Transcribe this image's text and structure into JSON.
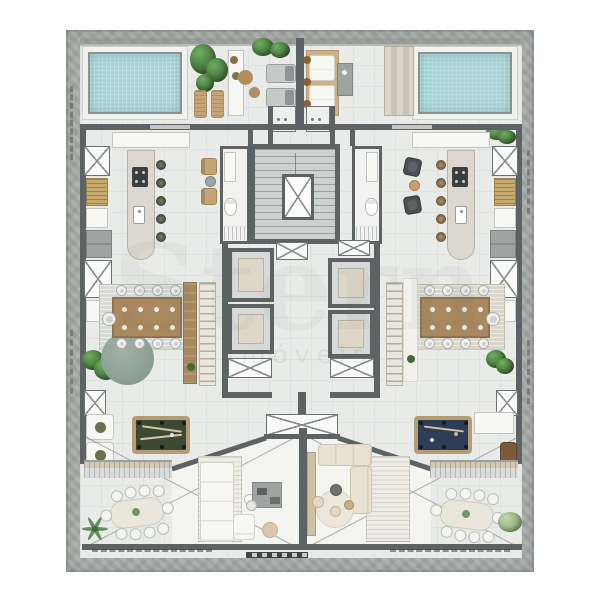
{
  "app": {
    "type": "architectural floor plan",
    "view": "top-down furnished render",
    "canvas": "600x600"
  },
  "watermark": {
    "large_text": "Stern",
    "small_text": "imóveis"
  },
  "colors": {
    "concrete": "#a8ada9",
    "concrete_dark": "#8f9490",
    "floor": "#e9ebe9",
    "tile_line": "#dfe2e0",
    "wall": "#5d6364",
    "pool_water": "#a3d5d7",
    "pool_rim": "#8a9092",
    "deck": "#f2f1ec",
    "white_furn": "#f7f7f4",
    "gray_furn": "#9fa3a2",
    "wood_tan": "#c3a577",
    "wood_slat": "#c6a96f",
    "dining_wood": "#a8895f",
    "dining_wood_dark": "#8f7350",
    "rug_round": "#8ea095",
    "shaft_beige": "#ded7c7",
    "felt_green": "#3c4a34",
    "felt_blue": "#2e3d56",
    "frame_wood": "#b59c74",
    "plant_light": "#6fae5f",
    "plant_mid": "#49793f",
    "plant_dark": "#2f5a2c",
    "beige_sofa": "#e9e2d2",
    "tan_pouf": "#d9c6ab"
  },
  "plan": {
    "layout": "two mirrored units around a central stair and elevator core",
    "core": {
      "features": [
        "staircase",
        "central elevator",
        "4 elevator shafts",
        "ventilation shafts (x-marked)",
        "left bathroom with toilet and shower",
        "right bathroom with toilet and shower",
        "entry grill counters (2)"
      ]
    },
    "shared_roof_terrace": {
      "items": [
        "lounge chairs (2)",
        "white sun loungers (2) with brown pillows",
        "tan sun loungers (2)",
        "ottomans (2)",
        "planters",
        "concrete side table",
        "stepped deck",
        "tall potted tree"
      ]
    },
    "unit_left": {
      "pool_terrace": [
        "swimming pool",
        "pool deck",
        "pool shelf",
        "sun loungers"
      ],
      "kitchen": [
        "island with cooktop and sink",
        "bar stools (5, olive)",
        "tan chairs (2) with round side table",
        "wall cabinets",
        "wood-slat cabinet",
        "appliance stack"
      ],
      "dining": [
        "wood dining table (9 seats)",
        "striped gray rug",
        "round green rug",
        "wood slat divider",
        "ladder shelf",
        "floor plants"
      ],
      "games_lounge": [
        "billiards table (green felt)",
        "white armchairs (2)"
      ],
      "living": [
        "white sectional sofa",
        "striped rug",
        "gray desk with chair",
        "tan ottoman",
        "coffee table"
      ],
      "terrace": [
        "outdoor oval dining table (10 seats)",
        "palm plant",
        "pergola band"
      ]
    },
    "unit_right": {
      "pool_terrace": [
        "swimming pool",
        "pool deck",
        "stepped platforms",
        "planter"
      ],
      "kitchen": [
        "island with cooktop and sink",
        "bar stools (5, brown)",
        "dark lounge chairs (2) with side table",
        "wall cabinets",
        "wood-slat cabinet",
        "appliance stack"
      ],
      "dining": [
        "wood dining table (9 seats)",
        "beige rug",
        "white sideboard with plant",
        "ladder shelf"
      ],
      "games_lounge": [
        "billiards table (blue felt)",
        "white bench",
        "leather armchair"
      ],
      "living": [
        "beige sectional sofa",
        "striped rug",
        "round beige rug",
        "poufs (2)",
        "dark side table",
        "tan door panel"
      ],
      "terrace": [
        "outdoor oval dining table (10 seats)",
        "soft green plant",
        "pergola band"
      ]
    },
    "annotations": [
      "ventilation shafts marked with X",
      "terrace void marked with diagonal cross lines",
      "graphic scale bar at bottom center",
      "dimension tick marks on concrete border"
    ]
  }
}
